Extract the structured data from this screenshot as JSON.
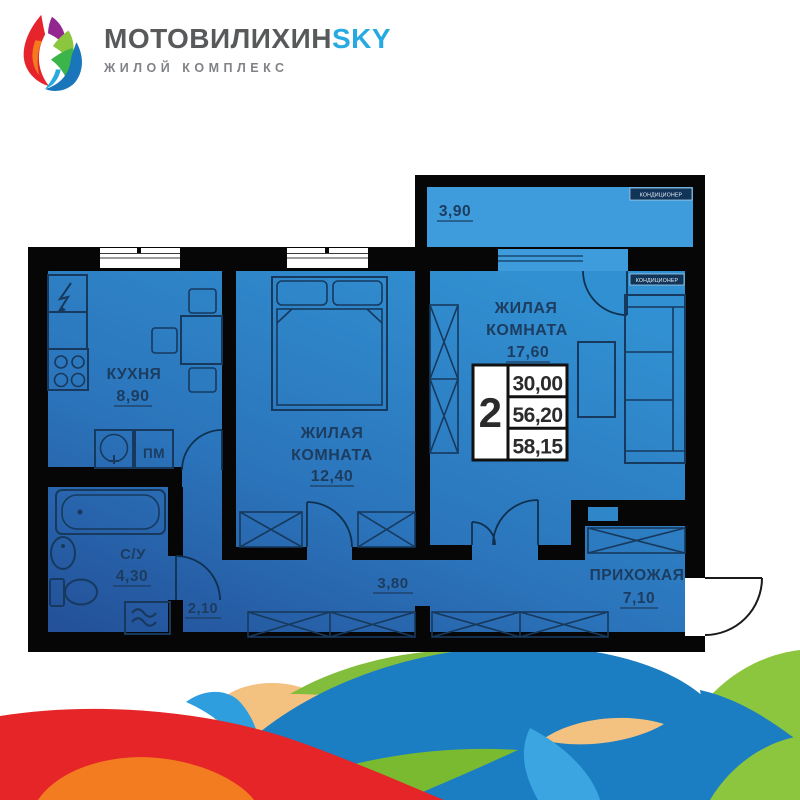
{
  "logo": {
    "brand": "МОТОВИЛИХИН",
    "brand_accent": "SKY",
    "tagline": "ЖИЛОЙ КОМПЛЕКС"
  },
  "plan": {
    "ac_label": "КОНДИЦИОНЕР",
    "balcony": {
      "area": "3,90"
    },
    "kitchen": {
      "name": "КУХНЯ",
      "area": "8,90",
      "appliance_label": "ПМ"
    },
    "bedroom": {
      "name_line1": "ЖИЛАЯ",
      "name_line2": "КОМНАТА",
      "area": "12,40"
    },
    "living_room": {
      "name_line1": "ЖИЛАЯ",
      "name_line2": "КОМНАТА",
      "area": "17,60"
    },
    "bathroom": {
      "name": "С/У",
      "area": "4,30"
    },
    "corridor": {
      "area": "3,80"
    },
    "corridor_small": {
      "area": "2,10"
    },
    "hallway": {
      "name": "ПРИХОЖАЯ",
      "area": "7,10"
    },
    "stats": {
      "rooms_count": "2",
      "values": [
        "30,00",
        "56,20",
        "58,15"
      ]
    }
  },
  "colors": {
    "wall": "#060606",
    "floor_top": "#3190D1",
    "floor_bottom": "#234F97",
    "balcony_floor": "#3E9CDC",
    "outline": "#17395E",
    "label": "#1C3C60",
    "brand_gray": "#58595B",
    "brand_blue": "#27AAE1",
    "wave_blue_dark": "#1B7DC2",
    "wave_blue_light": "#3AA5E1",
    "wave_green": "#8CC63E",
    "wave_red": "#E52528",
    "wave_orange": "#F47C20",
    "wave_tan": "#F3C180"
  }
}
